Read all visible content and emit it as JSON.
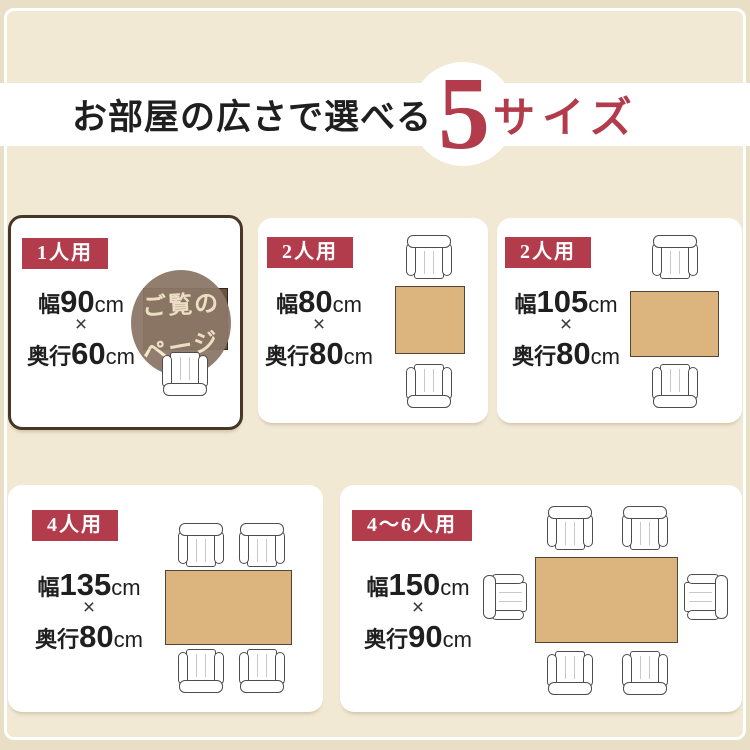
{
  "title": {
    "prefix": "お部屋の広さで選べる",
    "count": "5",
    "suffix": "サイズ"
  },
  "colors": {
    "accent": "#b23c4b",
    "outer-bg": "#e8dfc6",
    "inner-bg": "#f1e9d4",
    "band-bg": "#ffffff",
    "card-bg": "#ffffff",
    "card-border": "#463729",
    "table-tan": "#dcb57e",
    "table-dark": "#6a5440",
    "circle-bg": "#8c7767",
    "circle-text": "#f4e8cc",
    "ink": "#1f1f1f",
    "chair-line": "#4d4d4d"
  },
  "cards": [
    {
      "badge": "1人用",
      "w_label": "幅",
      "w_value": "90",
      "unit": "cm",
      "times": "×",
      "d_label": "奥行",
      "d_value": "60",
      "overlay_line1": "ご覧の",
      "overlay_line2": "ページ"
    },
    {
      "badge": "2人用",
      "w_label": "幅",
      "w_value": "80",
      "unit": "cm",
      "times": "×",
      "d_label": "奥行",
      "d_value": "80"
    },
    {
      "badge": "2人用",
      "w_label": "幅",
      "w_value": "105",
      "unit": "cm",
      "times": "×",
      "d_label": "奥行",
      "d_value": "80"
    },
    {
      "badge": "4人用",
      "w_label": "幅",
      "w_value": "135",
      "unit": "cm",
      "times": "×",
      "d_label": "奥行",
      "d_value": "80"
    },
    {
      "badge": "4〜6人用",
      "w_label": "幅",
      "w_value": "150",
      "unit": "cm",
      "times": "×",
      "d_label": "奥行",
      "d_value": "90"
    }
  ]
}
